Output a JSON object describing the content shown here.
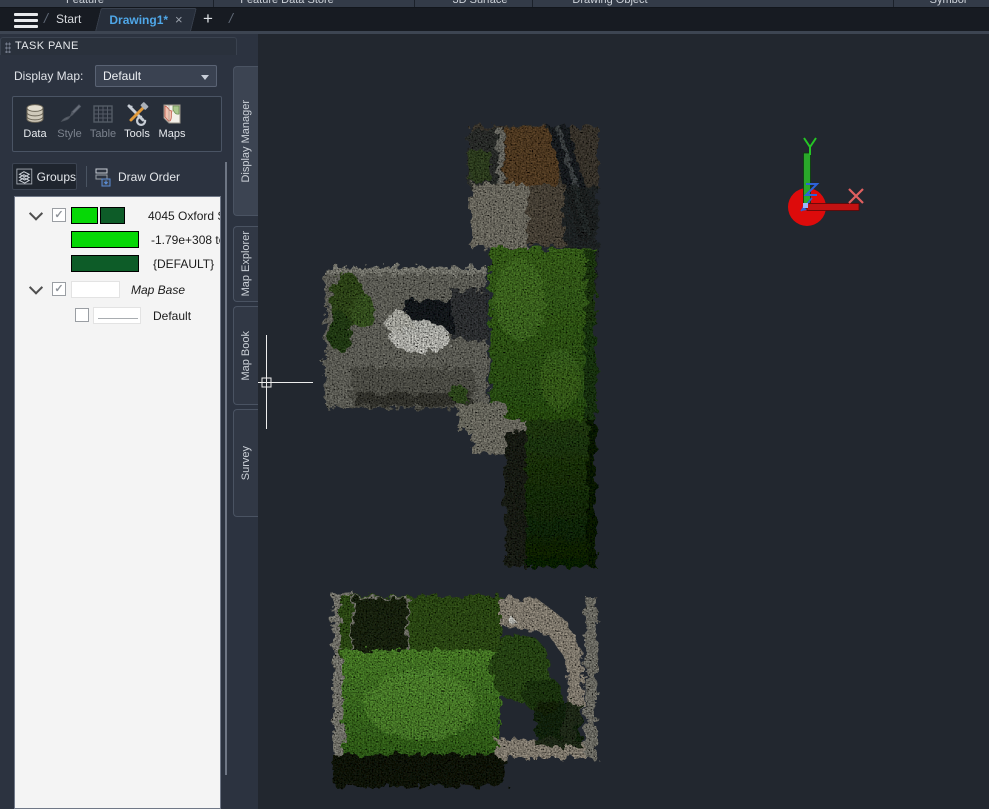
{
  "ribbon": {
    "panels": [
      "Feature",
      "Feature Data Store",
      "3D Surface",
      "Drawing Object",
      "Symbol"
    ]
  },
  "tab_bar": {
    "start_tab": "Start",
    "active_tab": "Drawing1*",
    "close_glyph": "×",
    "new_tab_glyph": "+",
    "separator_glyph": "/"
  },
  "task_pane": {
    "title": "TASK PANE",
    "display_map_label": "Display Map:",
    "display_map_value": "Default",
    "toolbar": {
      "items": [
        {
          "label": "Data",
          "enabled": true
        },
        {
          "label": "Style",
          "enabled": false
        },
        {
          "label": "Table",
          "enabled": false
        },
        {
          "label": "Tools",
          "enabled": true
        },
        {
          "label": "Maps",
          "enabled": true
        }
      ]
    },
    "view_buttons": {
      "groups": "Groups",
      "draw_order": "Draw Order"
    },
    "tree": {
      "rows": [
        {
          "label": "4045 Oxford S",
          "checked": "✓"
        },
        {
          "label": "-1.79e+308 to"
        },
        {
          "label": "{DEFAULT}"
        },
        {
          "label": "Map Base",
          "checked": "✓"
        },
        {
          "label": "Default"
        }
      ]
    }
  },
  "side_tabs": [
    {
      "label": "Display Manager",
      "active": true
    },
    {
      "label": "Map Explorer",
      "active": false
    },
    {
      "label": "Map Book",
      "active": false
    },
    {
      "label": "Survey",
      "active": false
    }
  ],
  "canvas": {
    "axis_labels": {
      "x": "X",
      "y": "Y",
      "z": "Z"
    }
  },
  "colors": {
    "active_tab_text": "#4fa7e8",
    "bright_green": "#06d806",
    "dark_green": "#0d5c28",
    "ucs_red": "#dd0b0b",
    "ucs_green": "#2aa82a",
    "ucs_blue": "#2d62d8"
  }
}
